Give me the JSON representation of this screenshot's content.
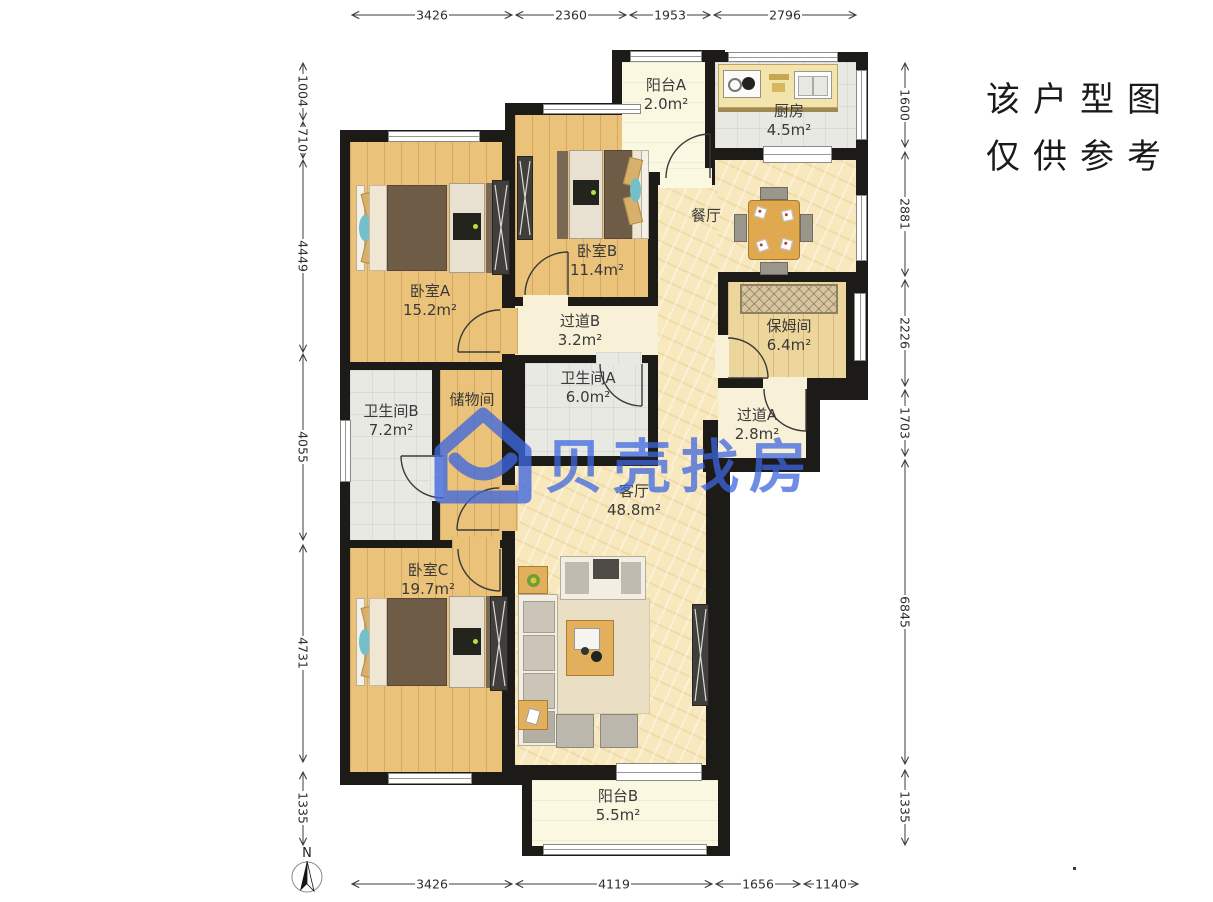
{
  "meta": {
    "disclaimer_line1": "该户型图",
    "disclaimer_line2": "仅供参考",
    "north_label": "N"
  },
  "watermark": {
    "text": "贝壳找房",
    "logo": "beike-house-logo",
    "color": "#3E67DF"
  },
  "colors": {
    "wall": "#1d1b17",
    "wood_floor": "#eac279",
    "open_floor": "#f7e8bd",
    "tile_floor": "#e9e9e4",
    "balcony_floor": "#fbf8e2"
  },
  "rooms": [
    {
      "id": "balcony_a",
      "name": "阳台A",
      "area": "2.0m²"
    },
    {
      "id": "kitchen",
      "name": "厨房",
      "area": "4.5m²"
    },
    {
      "id": "dining",
      "name": "餐厅",
      "area": ""
    },
    {
      "id": "bedroom_b",
      "name": "卧室B",
      "area": "11.4m²"
    },
    {
      "id": "bedroom_a",
      "name": "卧室A",
      "area": "15.2m²"
    },
    {
      "id": "hallway_b",
      "name": "过道B",
      "area": "3.2m²"
    },
    {
      "id": "nanny_room",
      "name": "保姆间",
      "area": "6.4m²"
    },
    {
      "id": "bathroom_b",
      "name": "卫生间B",
      "area": "7.2m²"
    },
    {
      "id": "storage",
      "name": "储物间",
      "area": ""
    },
    {
      "id": "bathroom_a",
      "name": "卫生间A",
      "area": "6.0m²"
    },
    {
      "id": "hallway_a",
      "name": "过道A",
      "area": "2.8m²"
    },
    {
      "id": "living",
      "name": "客厅",
      "area": "48.8m²"
    },
    {
      "id": "bedroom_c",
      "name": "卧室C",
      "area": "19.7m²"
    },
    {
      "id": "balcony_b",
      "name": "阳台B",
      "area": "5.5m²"
    }
  ],
  "dimensions": {
    "top": [
      "3426",
      "2360",
      "1953",
      "2796"
    ],
    "bottom": [
      "3426",
      "4119",
      "1656",
      "1140"
    ],
    "left": [
      "1004",
      "710",
      "4449",
      "4055",
      "4731",
      "1335"
    ],
    "right": [
      "1600",
      "2881",
      "2226",
      "1703",
      "6845",
      "1335"
    ]
  }
}
